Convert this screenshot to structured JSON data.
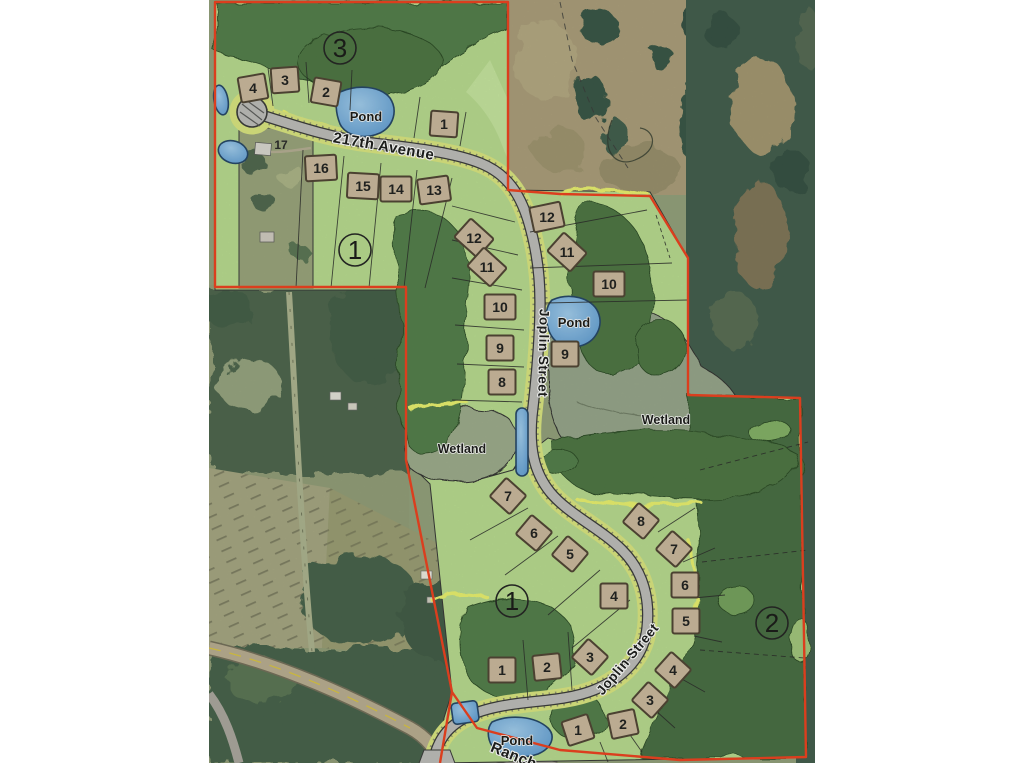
{
  "map": {
    "type": "subdivision-plat-over-aerial",
    "streets": [
      {
        "id": "street-217th-avenue",
        "text": "217th Avenue",
        "x": 383,
        "y": 151,
        "rot": 10,
        "size": 15
      },
      {
        "id": "street-joplin-upper",
        "text": "Joplin Street",
        "x": 539,
        "y": 353,
        "rot": 91,
        "size": 13.5
      },
      {
        "id": "street-joplin-lower",
        "text": "Joplin Street",
        "x": 631,
        "y": 662,
        "rot": -50,
        "size": 13.5
      },
      {
        "id": "street-ranch",
        "text": "Ranch",
        "x": 512,
        "y": 760,
        "rot": 22,
        "size": 15
      }
    ],
    "pond_labels": [
      {
        "text": "Pond",
        "x": 366,
        "y": 121,
        "size": 13
      },
      {
        "text": "Pond",
        "x": 574,
        "y": 327,
        "size": 13
      },
      {
        "text": "Pond",
        "x": 517,
        "y": 745,
        "size": 13
      }
    ],
    "wetland_labels": [
      {
        "text": "Wetland",
        "x": 462,
        "y": 453,
        "size": 12.5
      },
      {
        "text": "Wetland",
        "x": 666,
        "y": 424,
        "size": 12.5
      }
    ],
    "outlot_numbers": [
      {
        "text": "3",
        "x": 340,
        "y": 48
      },
      {
        "text": "1",
        "x": 355,
        "y": 250
      },
      {
        "text": "1",
        "x": 512,
        "y": 601
      },
      {
        "text": "2",
        "x": 772,
        "y": 623
      }
    ],
    "house_number": {
      "text": "17",
      "x": 281,
      "y": 149
    },
    "lots": [
      {
        "n": "4",
        "x": 253,
        "y": 88,
        "r": -10
      },
      {
        "n": "3",
        "x": 285,
        "y": 80,
        "r": -4
      },
      {
        "n": "2",
        "x": 326,
        "y": 92,
        "r": 10
      },
      {
        "n": "1",
        "x": 444,
        "y": 124,
        "r": 4
      },
      {
        "n": "16",
        "x": 321,
        "y": 168,
        "r": -3
      },
      {
        "n": "15",
        "x": 363,
        "y": 186,
        "r": 3
      },
      {
        "n": "14",
        "x": 396,
        "y": 189,
        "r": 0
      },
      {
        "n": "13",
        "x": 434,
        "y": 190,
        "r": -8
      },
      {
        "n": "12",
        "x": 474,
        "y": 238,
        "r": 42
      },
      {
        "n": "11",
        "x": 487,
        "y": 267,
        "r": 42
      },
      {
        "n": "10",
        "x": 500,
        "y": 307,
        "r": 0
      },
      {
        "n": "9",
        "x": 500,
        "y": 348,
        "r": 0
      },
      {
        "n": "8",
        "x": 502,
        "y": 382,
        "r": 0
      },
      {
        "n": "12",
        "x": 547,
        "y": 217,
        "r": -12
      },
      {
        "n": "11",
        "x": 567,
        "y": 252,
        "r": 42
      },
      {
        "n": "10",
        "x": 609,
        "y": 284,
        "r": 0
      },
      {
        "n": "9",
        "x": 565,
        "y": 354,
        "r": 0
      },
      {
        "n": "7",
        "x": 508,
        "y": 496,
        "r": 42
      },
      {
        "n": "6",
        "x": 534,
        "y": 533,
        "r": 40
      },
      {
        "n": "5",
        "x": 570,
        "y": 554,
        "r": 40
      },
      {
        "n": "4",
        "x": 614,
        "y": 596,
        "r": 0
      },
      {
        "n": "1",
        "x": 502,
        "y": 670,
        "r": 0
      },
      {
        "n": "2",
        "x": 547,
        "y": 667,
        "r": -6
      },
      {
        "n": "3",
        "x": 590,
        "y": 657,
        "r": 42
      },
      {
        "n": "8",
        "x": 641,
        "y": 521,
        "r": 40
      },
      {
        "n": "7",
        "x": 674,
        "y": 549,
        "r": 42
      },
      {
        "n": "6",
        "x": 685,
        "y": 585,
        "r": 0
      },
      {
        "n": "5",
        "x": 686,
        "y": 621,
        "r": 0
      },
      {
        "n": "4",
        "x": 673,
        "y": 670,
        "r": 42
      },
      {
        "n": "3",
        "x": 650,
        "y": 700,
        "r": 42
      },
      {
        "n": "2",
        "x": 623,
        "y": 724,
        "r": -12
      },
      {
        "n": "1",
        "x": 578,
        "y": 730,
        "r": -18
      }
    ],
    "colors": {
      "boundary_red": "#ee3a17",
      "plat_green": "#b6da8c",
      "tree_green": "#4e7a44",
      "verge_yellow": "#d9e57c",
      "fringe_yellow": "#e9f06b",
      "pond_blue": "#6aa6dc",
      "pad_tan": "#c9b69b",
      "asphalt_gray": "#bcbbb8",
      "wetland_gray_green": "#9aa888"
    }
  }
}
